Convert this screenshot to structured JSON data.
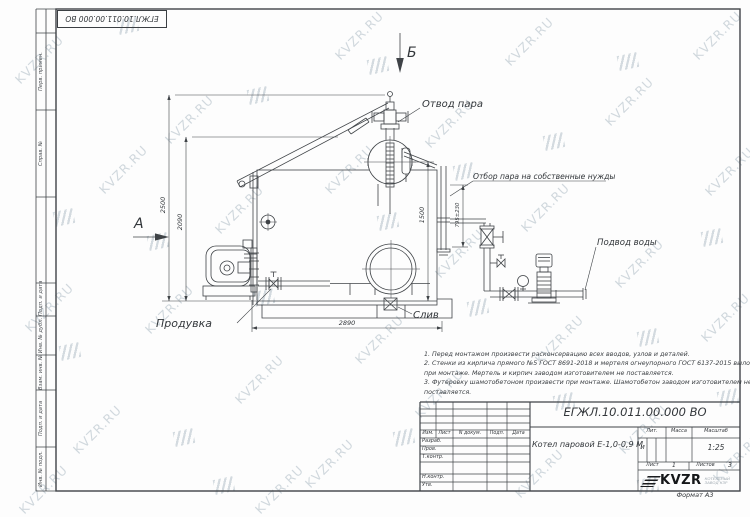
{
  "watermark": {
    "text": "KVZR.RU",
    "text_color": "#c6cfd6",
    "logo_color": "#c9d2d8",
    "text_positions": [
      [
        8,
        52
      ],
      [
        92,
        162
      ],
      [
        18,
        300
      ],
      [
        66,
        422
      ],
      [
        12,
        482
      ],
      [
        158,
        112
      ],
      [
        138,
        302
      ],
      [
        228,
        372
      ],
      [
        248,
        482
      ],
      [
        208,
        202
      ],
      [
        328,
        28
      ],
      [
        318,
        162
      ],
      [
        348,
        332
      ],
      [
        298,
        456
      ],
      [
        418,
        116
      ],
      [
        428,
        246
      ],
      [
        408,
        386
      ],
      [
        498,
        34
      ],
      [
        514,
        200
      ],
      [
        528,
        332
      ],
      [
        508,
        466
      ],
      [
        598,
        94
      ],
      [
        608,
        256
      ],
      [
        612,
        422
      ],
      [
        686,
        28
      ],
      [
        698,
        164
      ],
      [
        694,
        310
      ],
      [
        706,
        450
      ]
    ],
    "logo_positions": [
      [
        54,
        210
      ],
      [
        60,
        344
      ],
      [
        148,
        234
      ],
      [
        174,
        430
      ],
      [
        248,
        88
      ],
      [
        254,
        290
      ],
      [
        368,
        58
      ],
      [
        378,
        214
      ],
      [
        394,
        430
      ],
      [
        454,
        164
      ],
      [
        468,
        300
      ],
      [
        544,
        134
      ],
      [
        554,
        394
      ],
      [
        618,
        54
      ],
      [
        638,
        330
      ],
      [
        702,
        230
      ],
      [
        718,
        390
      ],
      [
        214,
        478
      ],
      [
        118,
        18
      ],
      [
        638,
        478
      ]
    ]
  },
  "frame": {
    "sidebar_labels": [
      "Перв. примен.",
      "Справ. №",
      "Подп. и дата",
      "Инв. № дубл.",
      "Взам. инв. №",
      "Подп. и дата",
      "Инв. № подл."
    ],
    "stamp_doc_number": "ЕГЖЛ.10.011.00.000  ВО",
    "format_label": "Формат А3"
  },
  "drawing": {
    "view_labels": {
      "a": "А",
      "b": "Б"
    },
    "callouts": {
      "steam_outlet": "Отвод пара",
      "steam_takeoff": "Отбор пара на собственные нужды",
      "water_inlet": "Подвод воды",
      "blowdown": "Продувка",
      "drain": "Слив"
    },
    "dimensions": {
      "total_height": "2500",
      "body_height": "2090",
      "drum_height": "1500",
      "base_length": "2890",
      "takeoff_height": "795±230"
    }
  },
  "notes": {
    "lines": [
      "1. Перед монтажом произвести расконсервацию всех вводов, узлов и деталей.",
      "2. Стенки из кирпича прямого №5 ГОСТ 8691-2018 и мертеля огнеупорного ГОСТ 6137-2015 выложить",
      "при монтаже. Мертель и кирпич заводом изготовителем не поставляется.",
      "3. Футеровку шамотобетоном произвести при монтаже. Шамотобетон заводом изготовителем не",
      "поставляется."
    ]
  },
  "title_block": {
    "doc_number": "ЕГЖЛ.10.011.00.000  ВО",
    "product_name": "Котел паровой Е-1,0-0,9 М",
    "header": {
      "izm": "Изм.",
      "list": "Лист",
      "doc": "N докум.",
      "sign": "Подп.",
      "date": "Дата"
    },
    "roles": [
      "Разраб.",
      "Пров.",
      "Т.контр.",
      "Н.контр.",
      "Утв."
    ],
    "lit_label": "Лит.",
    "lit_value": "и",
    "mass_label": "Масса",
    "scale_label": "Масштаб",
    "scale_value": "1:25",
    "sheet_label": "Лист",
    "sheet_value": "1",
    "sheets_label": "Листов",
    "sheets_value": "3",
    "brand": "KVZR",
    "brand_sub1": "КОТЕЛЬНЫЙ",
    "brand_sub2": "ЗАВОД КЗР"
  }
}
